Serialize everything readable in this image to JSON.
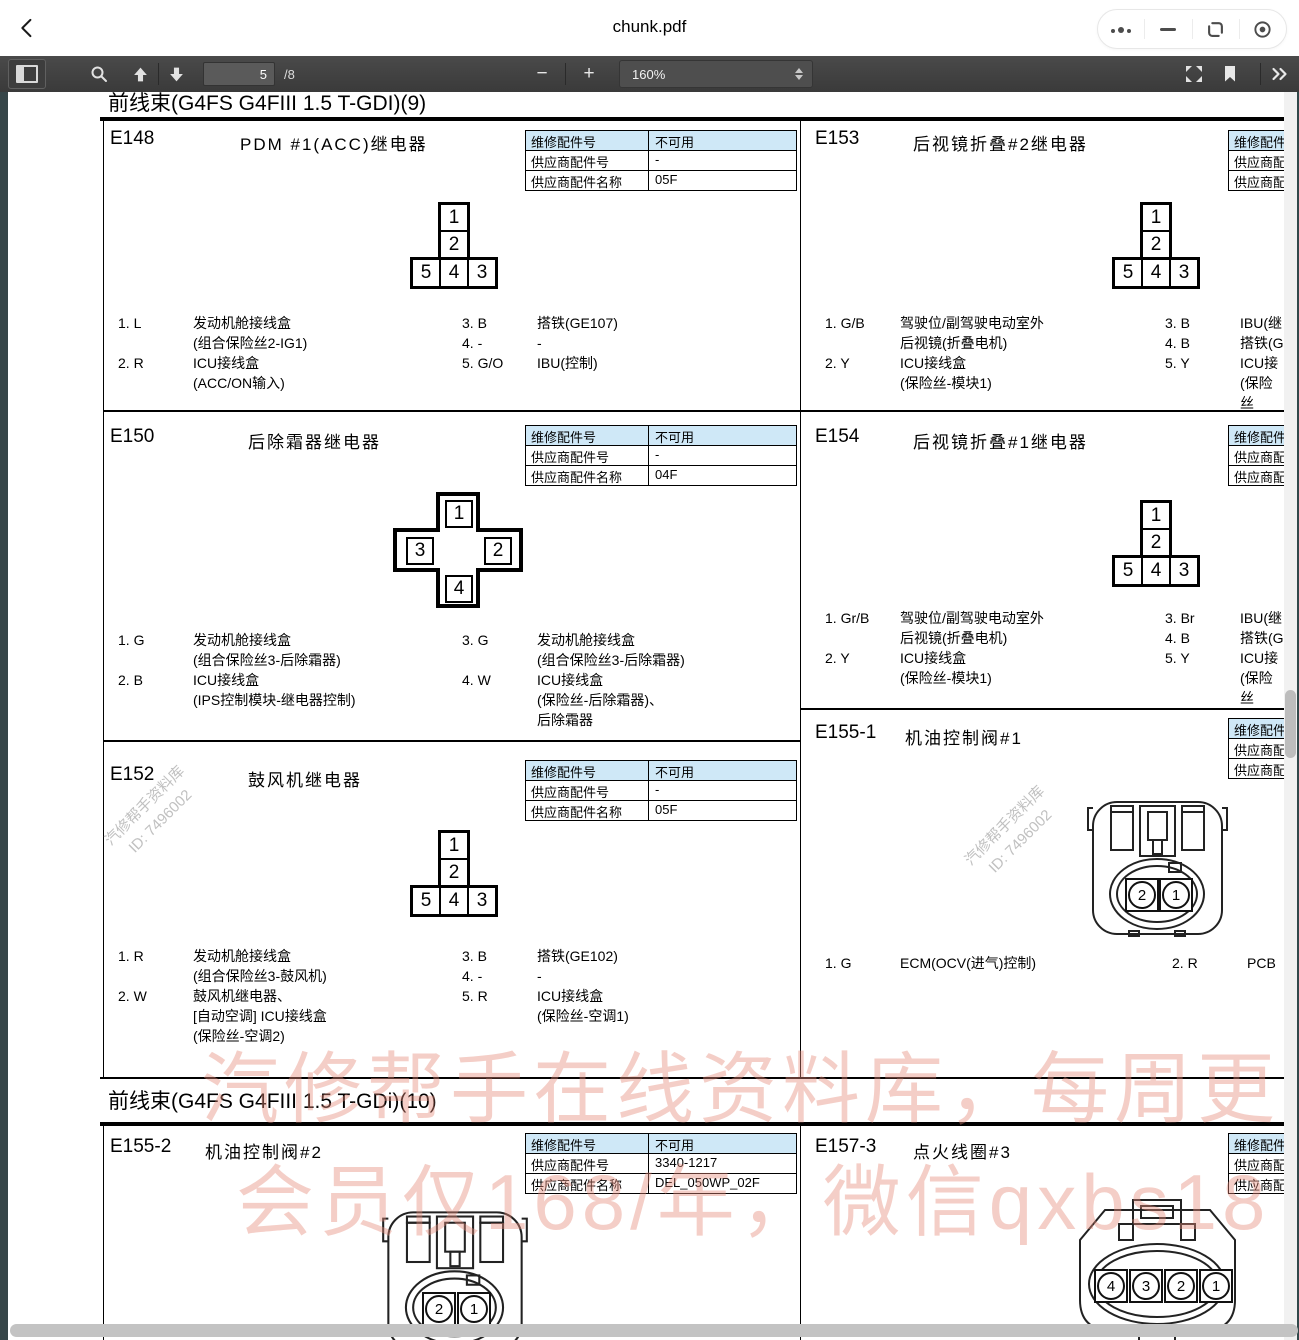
{
  "window": {
    "title": "chunk.pdf"
  },
  "toolbar": {
    "page_current": "5",
    "page_suffix": "/8",
    "zoom_value": "160%"
  },
  "watermarks": {
    "stamp_line1": "汽修帮手资料库",
    "stamp_line2": "ID: 7496002",
    "banner_line1": "汽修帮手在线资料库，每周更",
    "banner_line2": "会员仅168/年，微信qxbs18"
  },
  "doc": {
    "sec9": {
      "header": "前线束(G4FS  G4FIII 1.5 T-GDI)(9)",
      "e148": {
        "id": "E148",
        "title": "PDM #1(ACC)继电器",
        "table": [
          [
            "维修配件号",
            "不可用"
          ],
          [
            "供应商配件号",
            "-"
          ],
          [
            "供应商配件名称",
            "05F"
          ]
        ],
        "conn": [
          "1",
          "2",
          "5",
          "4",
          "3"
        ],
        "pinsL": [
          {
            "l": "1. L",
            "d": "发动机舱接线盒\n(组合保险丝2-IG1)"
          },
          {
            "l": "2. R",
            "d": "ICU接线盒\n(ACC/ON输入)"
          }
        ],
        "pinsR": [
          {
            "l": "3. B",
            "d": "搭铁(GE107)"
          },
          {
            "l": "4. -",
            "d": "-"
          },
          {
            "l": "5. G/O",
            "d": "IBU(控制)"
          }
        ]
      },
      "e150": {
        "id": "E150",
        "title": "后除霜器继电器",
        "table": [
          [
            "维修配件号",
            "不可用"
          ],
          [
            "供应商配件号",
            "-"
          ],
          [
            "供应商配件名称",
            "04F"
          ]
        ],
        "conn": [
          "1",
          "3",
          "2",
          "4"
        ],
        "pinsL": [
          {
            "l": "1. G",
            "d": "发动机舱接线盒\n(组合保险丝3-后除霜器)"
          },
          {
            "l": "2. B",
            "d": "ICU接线盒\n(IPS控制模块-继电器控制)"
          }
        ],
        "pinsR": [
          {
            "l": "3. G",
            "d": "发动机舱接线盒\n(组合保险丝3-后除霜器)"
          },
          {
            "l": "4. W",
            "d": "ICU接线盒\n(保险丝-后除霜器)、\n后除霜器"
          }
        ]
      },
      "e152": {
        "id": "E152",
        "title": "鼓风机继电器",
        "table": [
          [
            "维修配件号",
            "不可用"
          ],
          [
            "供应商配件号",
            "-"
          ],
          [
            "供应商配件名称",
            "05F"
          ]
        ],
        "conn": [
          "1",
          "2",
          "5",
          "4",
          "3"
        ],
        "pinsL": [
          {
            "l": "1. R",
            "d": "发动机舱接线盒\n(组合保险丝3-鼓风机)"
          },
          {
            "l": "2. W",
            "d": "鼓风机继电器、\n[自动空调] ICU接线盒\n(保险丝-空调2)"
          }
        ],
        "pinsR": [
          {
            "l": "3. B",
            "d": "搭铁(GE102)"
          },
          {
            "l": "4. -",
            "d": "-"
          },
          {
            "l": "5. R",
            "d": "ICU接线盒\n(保险丝-空调1)"
          }
        ]
      },
      "e153": {
        "id": "E153",
        "title": "后视镜折叠#2继电器",
        "table": [
          [
            "维修配件号",
            ""
          ],
          [
            "供应商配件号",
            ""
          ],
          [
            "供应商配件名称",
            ""
          ]
        ],
        "conn": [
          "1",
          "2",
          "5",
          "4",
          "3"
        ],
        "pinsL": [
          {
            "l": "1. G/B",
            "d": "驾驶位/副驾驶电动室外\n后视镜(折叠电机)"
          },
          {
            "l": "2. Y",
            "d": "ICU接线盒\n(保险丝-模块1)"
          }
        ],
        "pinsR": [
          {
            "l": "3. B",
            "d": "IBU(继"
          },
          {
            "l": "4. B",
            "d": "搭铁(G"
          },
          {
            "l": "5. Y",
            "d": "ICU接\n(保险丝"
          }
        ]
      },
      "e154": {
        "id": "E154",
        "title": "后视镜折叠#1继电器",
        "table": [
          [
            "维修配件号",
            ""
          ],
          [
            "供应商配件号",
            ""
          ],
          [
            "供应商配件名称",
            ""
          ]
        ],
        "conn": [
          "1",
          "2",
          "5",
          "4",
          "3"
        ],
        "pinsL": [
          {
            "l": "1. Gr/B",
            "d": "驾驶位/副驾驶电动室外\n后视镜(折叠电机)"
          },
          {
            "l": "2. Y",
            "d": "ICU接线盒\n(保险丝-模块1)"
          }
        ],
        "pinsR": [
          {
            "l": "3. Br",
            "d": "IBU(继"
          },
          {
            "l": "4. B",
            "d": "搭铁(G"
          },
          {
            "l": "5. Y",
            "d": "ICU接\n(保险丝"
          }
        ]
      },
      "e155_1": {
        "id": "E155-1",
        "title": "机油控制阀#1",
        "table": [
          [
            "维修配件号",
            ""
          ],
          [
            "供应商配件号",
            ""
          ],
          [
            "供应商配件名称",
            ""
          ]
        ],
        "conn": [
          "2",
          "1"
        ],
        "pinsL": [
          {
            "l": "1. G",
            "d": "ECM(OCV(进气)控制)"
          }
        ],
        "pinsR": [
          {
            "l": "2. R",
            "d": "PCB"
          }
        ]
      }
    },
    "sec10": {
      "header": "前线束(G4FS  G4FIII 1.5 T-GDi)(10)",
      "e155_2": {
        "id": "E155-2",
        "title": "机油控制阀#2",
        "table": [
          [
            "维修配件号",
            "不可用"
          ],
          [
            "供应商配件号",
            "3340-1217"
          ],
          [
            "供应商配件名称",
            "DEL_050WP_02F"
          ]
        ],
        "conn": [
          "2",
          "1"
        ]
      },
      "e157_3": {
        "id": "E157-3",
        "title": "点火线圈#3",
        "table": [
          [
            "维修配件号",
            ""
          ],
          [
            "供应商配件号",
            ""
          ],
          [
            "供应商配件名称",
            ""
          ]
        ],
        "conn": [
          "4",
          "3",
          "2",
          "1"
        ]
      }
    }
  }
}
